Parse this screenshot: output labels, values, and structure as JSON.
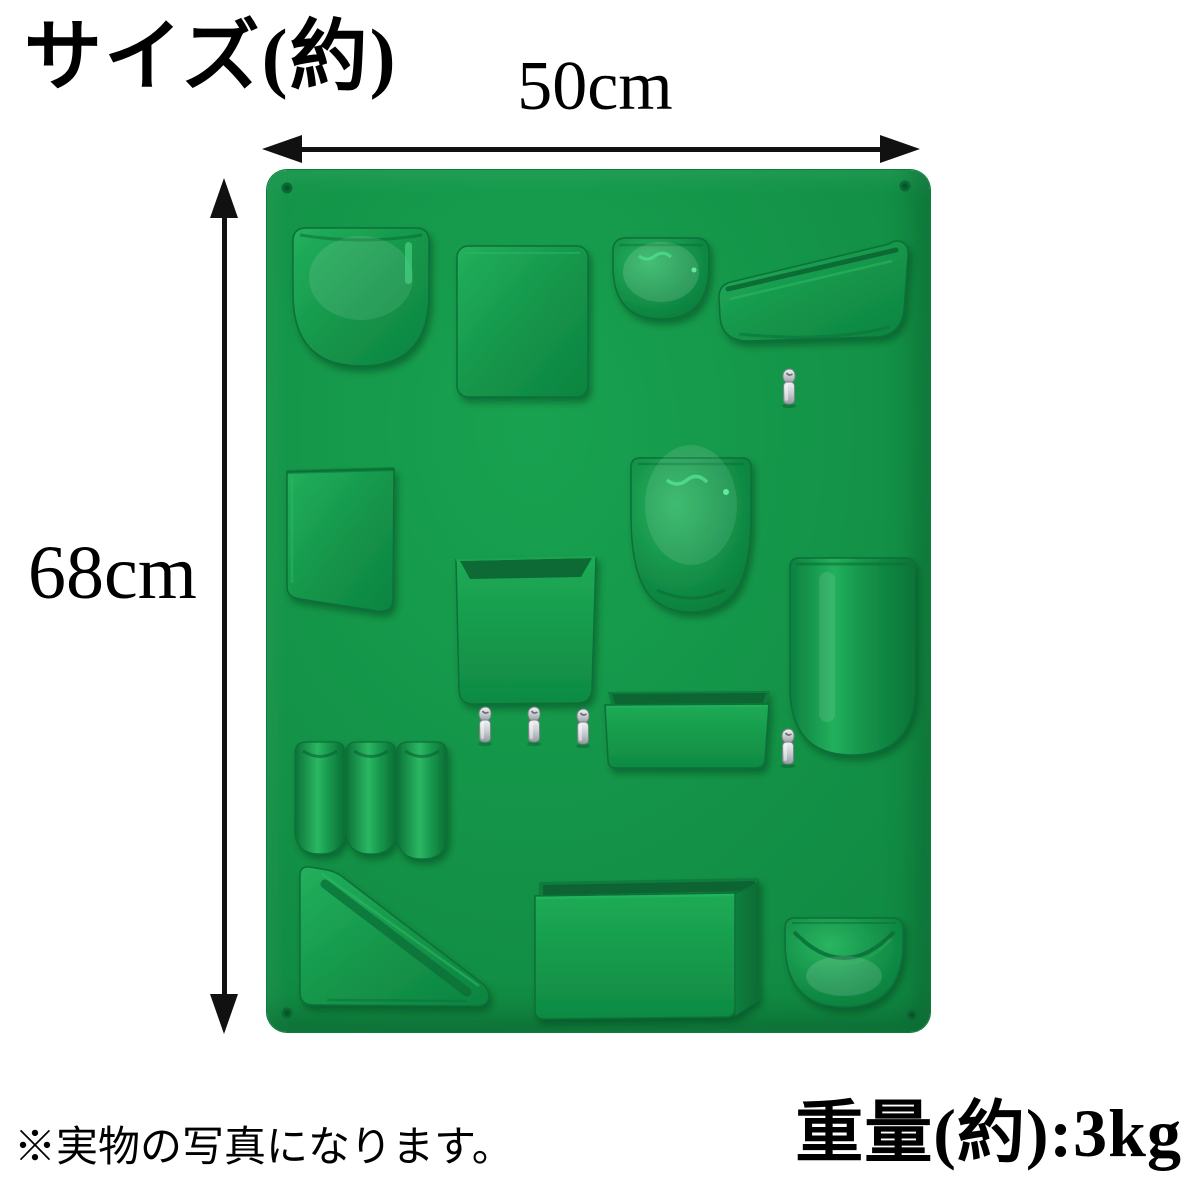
{
  "title": "サイズ(約)",
  "dimensions": {
    "width_label": "50cm",
    "height_label": "68cm"
  },
  "weight_label": "重量(約):3kg",
  "note": "※実物の写真になります。",
  "colors": {
    "board_green": "#149549",
    "pocket_green_light": "#22b05c",
    "pocket_green_dark": "#0d8441",
    "outline_green": "#0a7038",
    "recess_green": "#0a6b34",
    "highlight_green": "#4fe08d",
    "hook_silver": "#c4c9cc",
    "annotation_black": "#111111",
    "background_white": "#ffffff"
  },
  "board": {
    "name": "wall-mounted-organizer",
    "hook_count": 5,
    "screw_hole_count": 4,
    "pockets": [
      "top-left-u-pocket",
      "top-flap-box",
      "small-dome-bowl",
      "angled-pen-tray",
      "slant-bottom-pocket",
      "egg-container",
      "center-open-box",
      "tall-u-pocket",
      "small-shelf-tray",
      "tube-pockets",
      "wedge-shelf",
      "large-tray",
      "half-round-bowl"
    ]
  }
}
